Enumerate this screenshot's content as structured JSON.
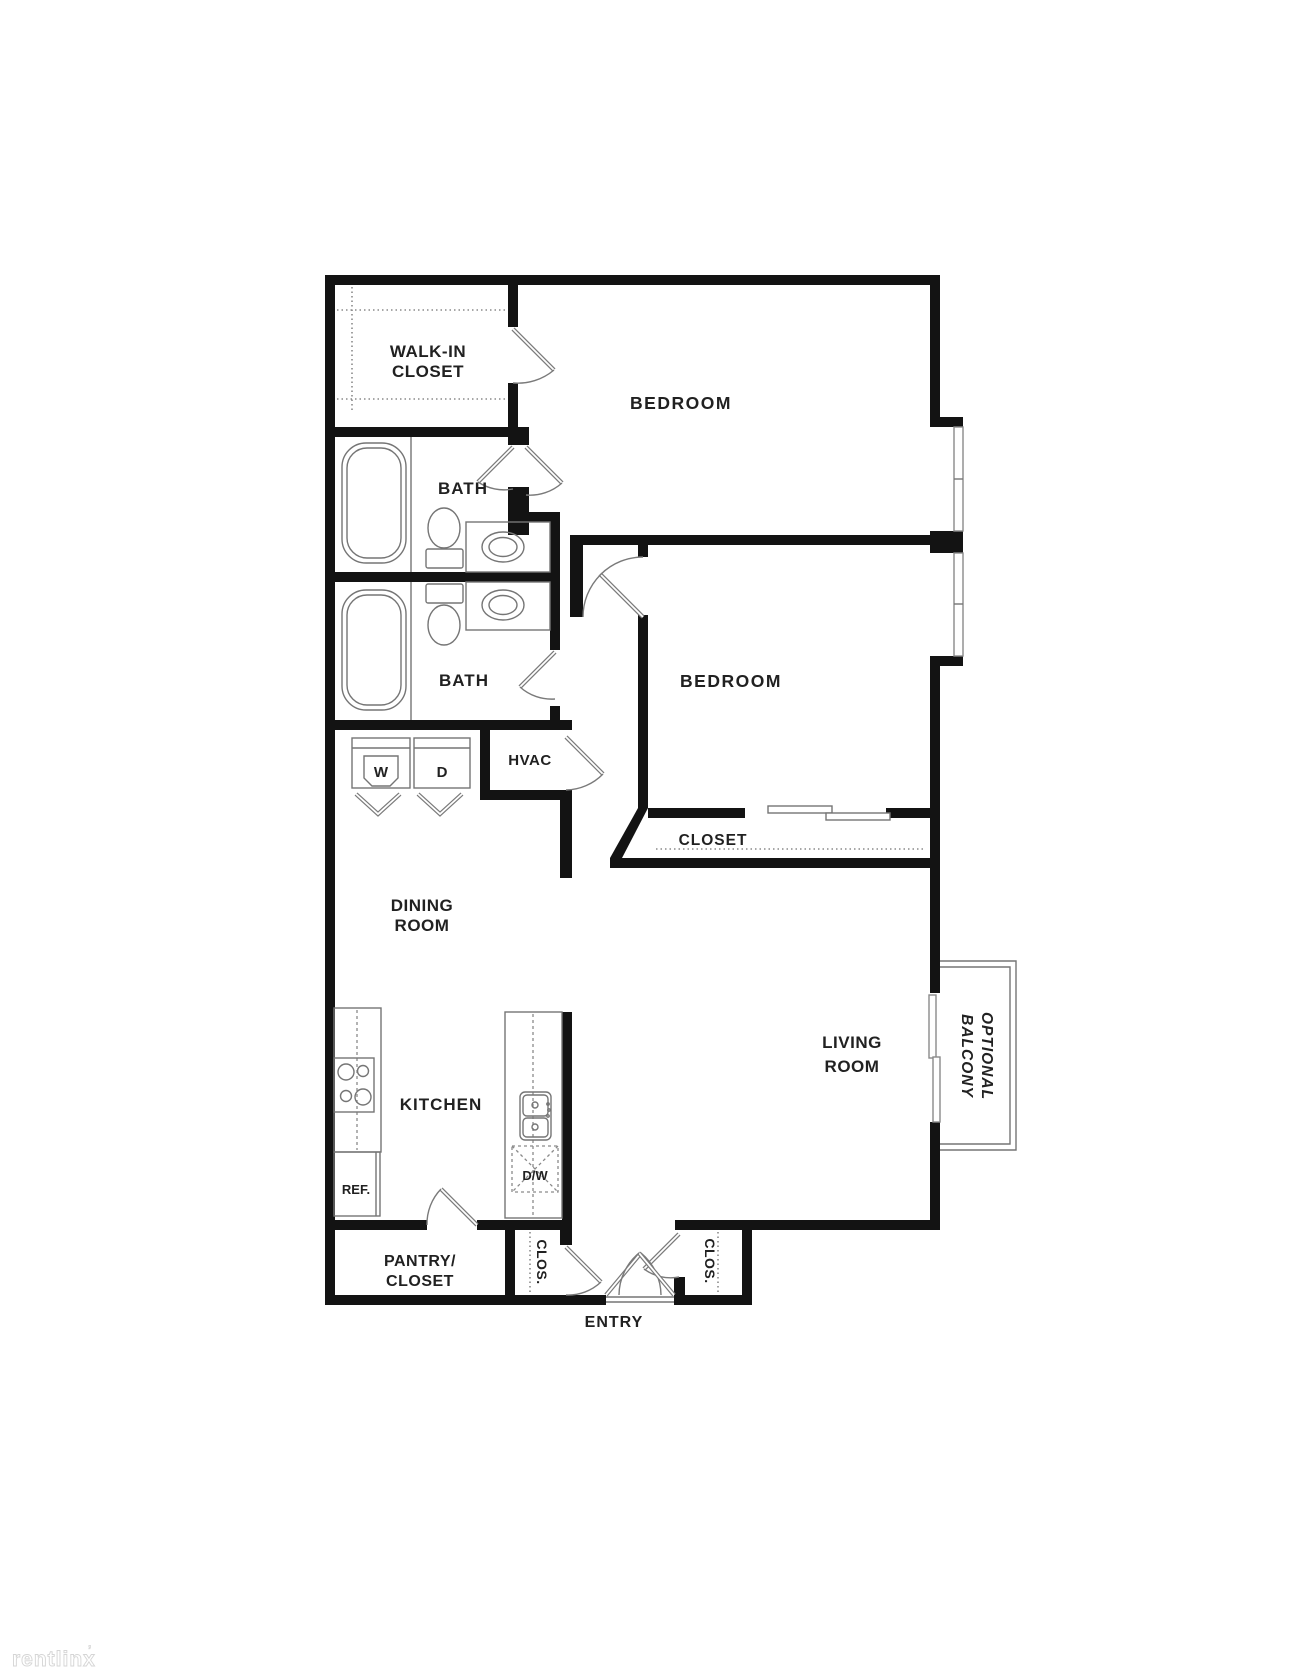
{
  "page": {
    "background": "#ffffff",
    "type": "floor-plan"
  },
  "colors": {
    "wall": "#131313",
    "fixture": "#757575",
    "dashed": "#8a8a8a",
    "label": "#212121",
    "door": "#7a7a7a",
    "watermark_fill": "#ffffff",
    "watermark_stroke": "#d5d5d5"
  },
  "labels": {
    "walk_in_closet_line1": "WALK-IN",
    "walk_in_closet_line2": "CLOSET",
    "bedroom_top": "BEDROOM",
    "bath_top": "BATH",
    "bath_bottom": "BATH",
    "bedroom_bottom": "BEDROOM",
    "washer": "W",
    "dryer": "D",
    "hvac": "HVAC",
    "bedroom_closet": "CLOSET",
    "dining_line1": "DINING",
    "dining_line2": "ROOM",
    "living_line1": "LIVING",
    "living_line2": "ROOM",
    "balcony_line1": "OPTIONAL",
    "balcony_line2": "BALCONY",
    "kitchen": "KITCHEN",
    "refrigerator": "REF.",
    "dishwasher": "D/W",
    "pantry_line1": "PANTRY/",
    "pantry_line2": "CLOSET",
    "closet_left": "CLOS.",
    "closet_right": "CLOS.",
    "entry": "ENTRY",
    "watermark": "rentlinx",
    "watermark_mark": "’"
  }
}
